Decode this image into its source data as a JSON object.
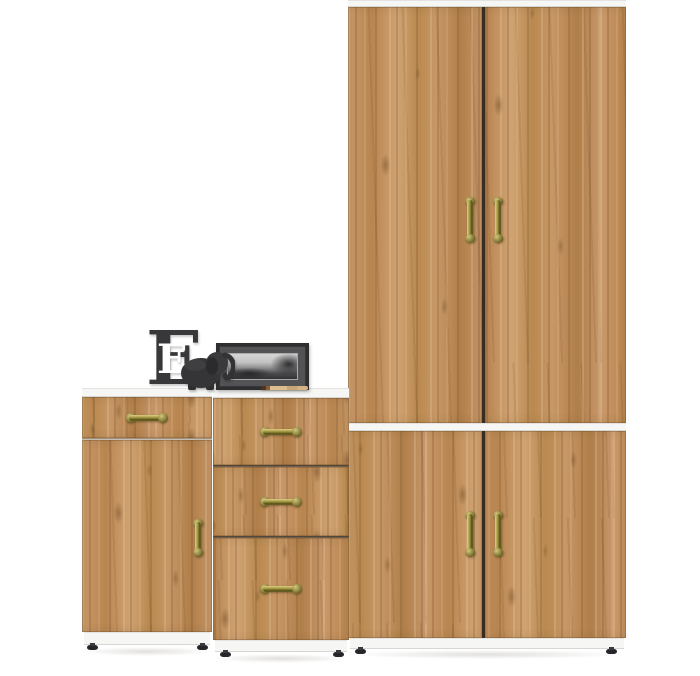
{
  "scene": {
    "type": "furniture product photo",
    "subject": "Oak hallway storage set with white trim and antique brass handles",
    "background_color": "#ffffff"
  },
  "palette": {
    "wood_mid": "#c2925f",
    "wood_dark": "#8a6240",
    "wood_light": "#dcb183",
    "trim_white": "#f6f6f5",
    "brass": "#a0933f",
    "brass_dark": "#4e4717",
    "door_gap_dark": "#372d22",
    "decor_gray": "#38383a",
    "foot_black": "#26262a"
  },
  "furniture": {
    "wardrobe": {
      "name": "tall double-door wardrobe with lower double-door cabinet",
      "upper_doors": 2,
      "lower_doors": 2,
      "handle_count": 4,
      "feet_count": 2
    },
    "chest": {
      "name": "three-drawer chest",
      "drawer_count": 3,
      "handle_count": 3,
      "feet_count": 2
    },
    "cabinet": {
      "name": "single-drawer single-door cabinet",
      "drawer_count": 1,
      "door_count": 1,
      "handle_count": 2,
      "feet_count": 2
    }
  },
  "decor": {
    "letter_block": {
      "character": "E",
      "color": "#38383a"
    },
    "figurine": {
      "kind": "elephant",
      "color": "#39393b"
    },
    "photo_frame": {
      "style": "black frame, gray mat, monochrome landscape photo"
    },
    "pencil": {
      "color": "#dcbd90"
    }
  }
}
